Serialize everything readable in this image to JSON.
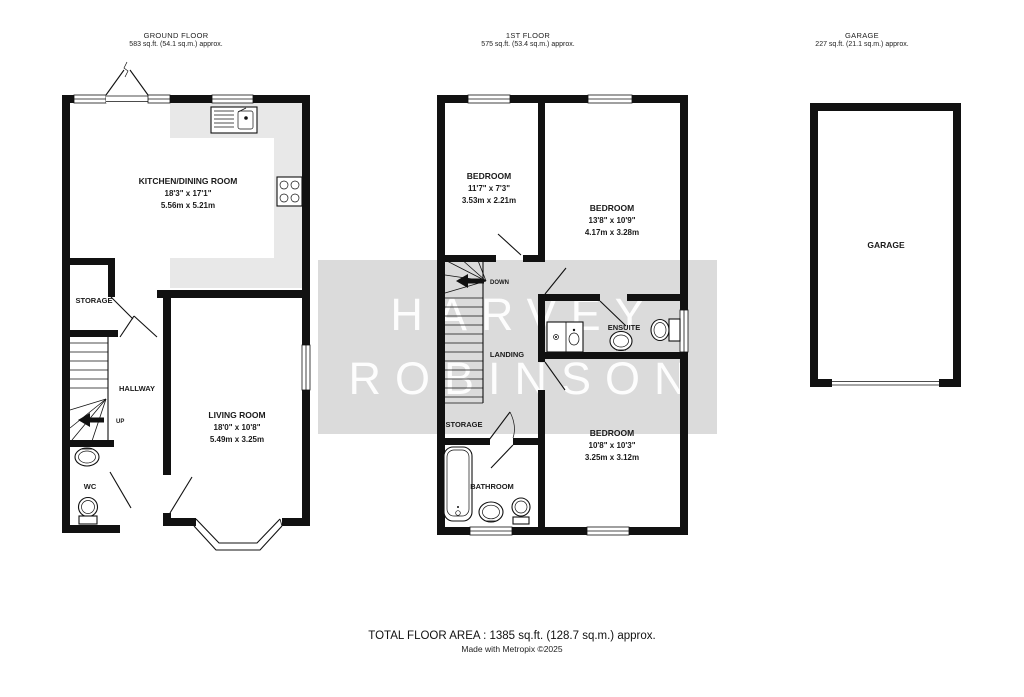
{
  "colors": {
    "wall": "#111111",
    "counter": "#e8e8e8",
    "watermark_band": "#dbdbdb",
    "watermark_text": "#ffffff",
    "label_text": "#1a1a1a"
  },
  "headers": {
    "ground_floor": {
      "title": "GROUND FLOOR",
      "area": "583 sq.ft. (54.1 sq.m.) approx."
    },
    "first_floor": {
      "title": "1ST FLOOR",
      "area": "575 sq.ft. (53.4 sq.m.) approx."
    },
    "garage": {
      "title": "GARAGE",
      "area": "227 sq.ft. (21.1 sq.m.) approx."
    }
  },
  "watermark": {
    "line1": "HARVEY",
    "line2": "ROBINSON"
  },
  "ground_floor": {
    "kitchen": {
      "name": "KITCHEN/DINING ROOM",
      "imperial": "18'3\" x 17'1\"",
      "metric": "5.56m x 5.21m"
    },
    "living": {
      "name": "LIVING ROOM",
      "imperial": "18'0\" x 10'8\"",
      "metric": "5.49m x 3.25m"
    },
    "storage": {
      "name": "STORAGE"
    },
    "hallway": {
      "name": "HALLWAY"
    },
    "wc": {
      "name": "WC"
    },
    "stairs_label": "UP"
  },
  "first_floor": {
    "bedroom1": {
      "name": "BEDROOM",
      "imperial": "11'7\" x 7'3\"",
      "metric": "3.53m x 2.21m"
    },
    "bedroom2": {
      "name": "BEDROOM",
      "imperial": "13'8\" x 10'9\"",
      "metric": "4.17m x 3.28m"
    },
    "bedroom3": {
      "name": "BEDROOM",
      "imperial": "10'8\" x 10'3\"",
      "metric": "3.25m x 3.12m"
    },
    "landing": {
      "name": "LANDING"
    },
    "ensuite": {
      "name": "ENSUITE"
    },
    "storage": {
      "name": "STORAGE"
    },
    "bathroom": {
      "name": "BATHROOM"
    },
    "stairs_label": "DOWN"
  },
  "garage_plan": {
    "room": {
      "name": "GARAGE"
    }
  },
  "footer": {
    "total_area": "TOTAL FLOOR AREA : 1385 sq.ft. (128.7 sq.m.) approx.",
    "credit": "Made with Metropix ©2025"
  }
}
